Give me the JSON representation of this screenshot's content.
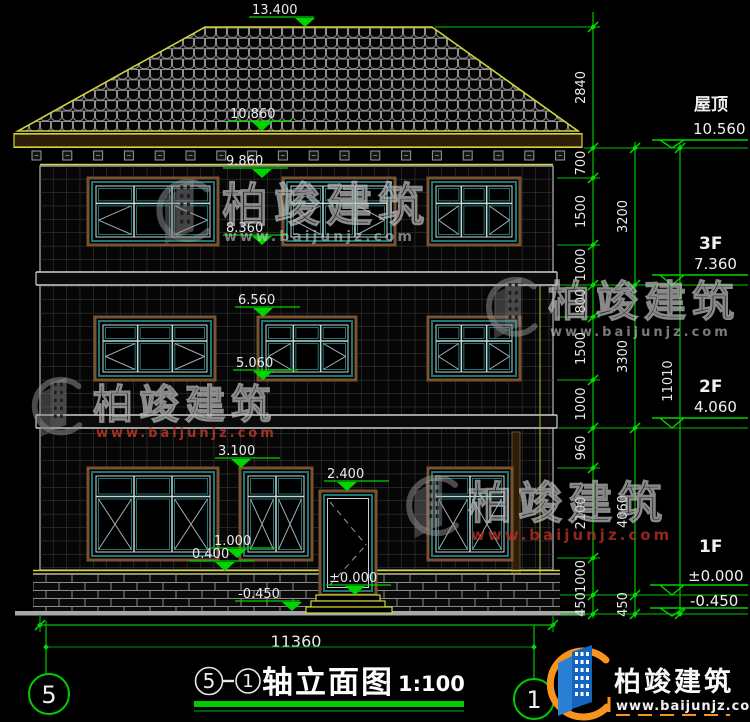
{
  "drawing": {
    "top_dimension": "13.400",
    "facade_markers": {
      "eave_top": "10.860",
      "f3_window_top": "9.860",
      "f3_window_sill": "8.360",
      "f2_window_top": "6.560",
      "f2_window_sill": "5.060",
      "f1_window_top": "3.100",
      "door_top": "2.400",
      "f1_window_sill": "1.000",
      "base_top": "0.400",
      "floor_zero": "±0.000",
      "ground": "-0.450"
    },
    "right_markers": {
      "roof_label": "屋顶",
      "roof_level": "10.560",
      "f3_label": "3F",
      "f3_level": "7.360",
      "f2_label": "2F",
      "f2_level": "4.060",
      "f1_label": "1F",
      "f1_zero": "±0.000",
      "f1_ground": "-0.450"
    },
    "dim_roof": "2840",
    "dims_col1": [
      "700",
      "1500",
      "1000",
      "800",
      "1500",
      "1000",
      "960",
      "2100",
      "1000",
      "450"
    ],
    "dims_col2": [
      "3200",
      "3300",
      "4060",
      "450"
    ],
    "dims_col3": [
      "11010"
    ],
    "bottom_dimension": "11360",
    "axis_left": "5",
    "axis_right": "1"
  },
  "title": {
    "axis_from": "5",
    "axis_to": "1",
    "name": "轴立面图",
    "scale": "1:100"
  },
  "watermark": {
    "brand": "柏竣建筑",
    "url": "www.baijunjz.com"
  },
  "colors": {
    "dim_green": "#00c400",
    "tick_green": "#00dd00",
    "cad_yellow": "#d2d23c",
    "window_teal": "#1e7878",
    "trim_brown": "#7a5230",
    "logo_blue": "#1565c0",
    "logo_orange": "#f7941d"
  }
}
